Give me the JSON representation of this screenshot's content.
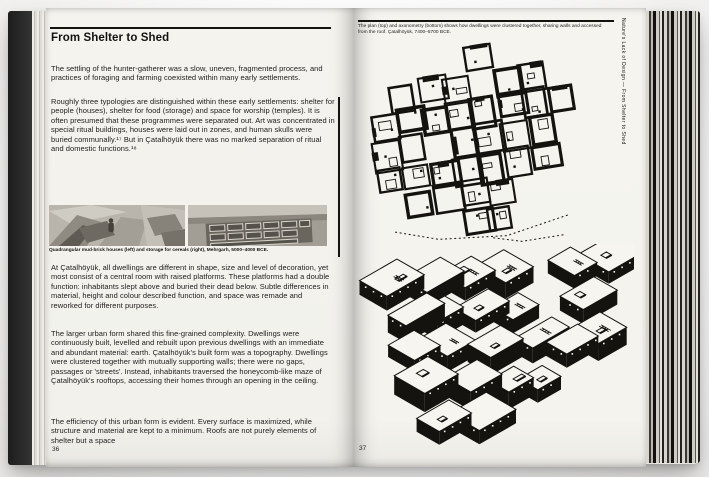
{
  "colors": {
    "ink": "#15130f",
    "paper": "#f3f2ed",
    "cover": "#1d1d1d"
  },
  "left_page": {
    "title": "From Shelter to Shed",
    "paragraphs": [
      "The settling of the hunter-gatherer was a slow, uneven, fragmented process, and practices of foraging and farming coexisted within many early settlements.",
      "Roughly three typologies are distinguished within these early settlements: shelter for people (houses), shelter for food (storage) and space for worship (temples). It is often presumed that these programmes were separated out. Art was concentrated in special ritual buildings, houses were laid out in zones, and human skulls were buried communally.¹⁷ But in Çatalhöyük there was no marked separation of ritual and domestic functions.¹⁸",
      "At Çatalhöyük, all dwellings are different in shape, size and level of decoration, yet most consist of a central room with raised platforms. These platforms had a double function: inhabitants slept above and buried their dead below. Subtle differences in material, height and colour described function, and space was remade and reworked for different purposes.",
      "The larger urban form shared this fine-grained complexity. Dwellings were continuously built, levelled and rebuilt upon previous dwellings with an immediate and abundant material: earth. Çatalhöyük's built form was a topography. Dwellings were clustered together with mutually supporting walls; there were no gaps, passages or 'streets'. Instead, inhabitants traversed the honeycomb-like maze of Çatalhöyük's rooftops, accessing their homes through an opening in the ceiling.",
      "The efficiency of this urban form is evident. Every surface is maximized, while structure and material are kept to a minimum. Roofs are not purely elements of shelter but a space"
    ],
    "photo_caption": "Quadrangular mud-brick houses (left) and storage for cereals (right), Mehrgarh, 5000–4000 BCE.",
    "page_number": "36"
  },
  "right_page": {
    "figure_caption": "The plan (top) and axonometry (bottom) shows how dwellings were clustered together, sharing walls and accessed from the roof. Çatalhöyük, 7400–5700 BCE.",
    "margin_text": "Nature's Lack of Design — From Shelter to Shed",
    "figures": [
      {
        "name": "plan",
        "description": "Archaeological plan of clustered mud-brick dwellings sharing walls"
      },
      {
        "name": "axonometric",
        "description": "Axonometric view of clustered dwellings accessed through roof openings"
      }
    ],
    "page_number": "37"
  }
}
